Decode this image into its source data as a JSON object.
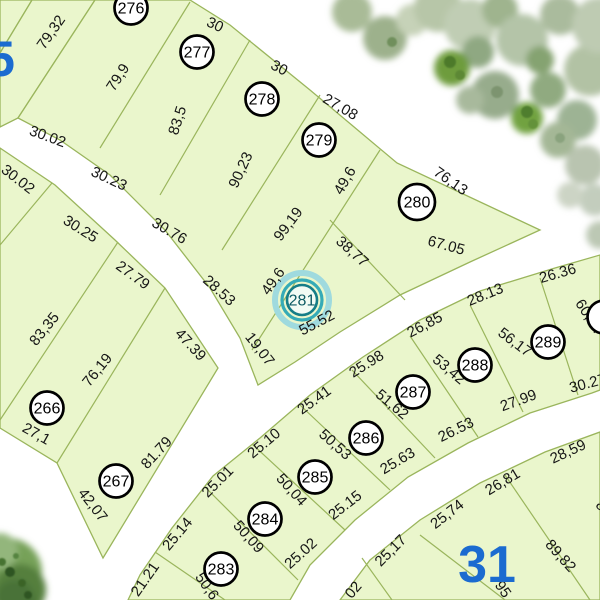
{
  "map": {
    "selected_parcel": "281",
    "colors": {
      "parcel_fill": "#eaf6cc",
      "parcel_stroke": "#9ab55c",
      "road": "#ffffff",
      "label_text": "#161616",
      "block_number_blue": "#1b6bd0",
      "highlight_teal_outer": "#9fdade",
      "highlight_teal_inner": "#35abb7"
    },
    "block_labels": [
      {
        "text": "5",
        "x": 1,
        "y": 76,
        "size": 50
      },
      {
        "text": "31",
        "x": 487,
        "y": 582,
        "size": 52
      }
    ],
    "parcel_badges": [
      {
        "num": "276",
        "x": 131,
        "y": 8,
        "r": 16.5,
        "selected": false
      },
      {
        "num": "277",
        "x": 197,
        "y": 52,
        "r": 16.5,
        "selected": false
      },
      {
        "num": "278",
        "x": 262,
        "y": 99,
        "r": 16.5,
        "selected": false
      },
      {
        "num": "279",
        "x": 319,
        "y": 140,
        "r": 16.5,
        "selected": false
      },
      {
        "num": "280",
        "x": 417,
        "y": 202,
        "r": 18,
        "selected": false
      },
      {
        "num": "281",
        "x": 302,
        "y": 300,
        "r": 15,
        "selected": true
      },
      {
        "num": "266",
        "x": 47,
        "y": 408,
        "r": 16.5,
        "selected": false
      },
      {
        "num": "267",
        "x": 116,
        "y": 481,
        "r": 16.5,
        "selected": false
      },
      {
        "num": "283",
        "x": 221,
        "y": 569,
        "r": 16.5,
        "selected": false
      },
      {
        "num": "284",
        "x": 265,
        "y": 519,
        "r": 16.5,
        "selected": false
      },
      {
        "num": "285",
        "x": 315,
        "y": 477,
        "r": 16.5,
        "selected": false
      },
      {
        "num": "286",
        "x": 366,
        "y": 438,
        "r": 16.5,
        "selected": false
      },
      {
        "num": "287",
        "x": 413,
        "y": 392,
        "r": 16.5,
        "selected": false
      },
      {
        "num": "288",
        "x": 475,
        "y": 365,
        "r": 16.5,
        "selected": false
      },
      {
        "num": "289",
        "x": 548,
        "y": 342,
        "r": 16.5,
        "selected": false
      },
      {
        "num": "",
        "x": 604,
        "y": 317,
        "r": 16.5,
        "selected": false
      }
    ],
    "dim_labels": [
      {
        "text": "79,32",
        "x": 55,
        "y": 35,
        "rot": -55
      },
      {
        "text": "79,9",
        "x": 122,
        "y": 80,
        "rot": -57
      },
      {
        "text": "30",
        "x": 213,
        "y": 29,
        "rot": 25
      },
      {
        "text": "30",
        "x": 277,
        "y": 72,
        "rot": 28
      },
      {
        "text": "27,08",
        "x": 338,
        "y": 111,
        "rot": 30
      },
      {
        "text": "76,13",
        "x": 448,
        "y": 185,
        "rot": 35
      },
      {
        "text": "30.02",
        "x": 46,
        "y": 141,
        "rot": 20
      },
      {
        "text": "30.23",
        "x": 107,
        "y": 183,
        "rot": 25
      },
      {
        "text": "30.76",
        "x": 167,
        "y": 235,
        "rot": 30
      },
      {
        "text": "28.53",
        "x": 216,
        "y": 294,
        "rot": 42
      },
      {
        "text": "19,07",
        "x": 256,
        "y": 352,
        "rot": 52
      },
      {
        "text": "83,5",
        "x": 182,
        "y": 122,
        "rot": -72
      },
      {
        "text": "90,23",
        "x": 245,
        "y": 172,
        "rot": -65
      },
      {
        "text": "49,6",
        "x": 349,
        "y": 183,
        "rot": -60
      },
      {
        "text": "99,19",
        "x": 292,
        "y": 227,
        "rot": -53
      },
      {
        "text": "49,6",
        "x": 277,
        "y": 284,
        "rot": -55
      },
      {
        "text": "38,77",
        "x": 349,
        "y": 255,
        "rot": 42
      },
      {
        "text": "67.05",
        "x": 445,
        "y": 250,
        "rot": 15
      },
      {
        "text": "55.52",
        "x": 319,
        "y": 327,
        "rot": -28
      },
      {
        "text": "30.02",
        "x": 15,
        "y": 183,
        "rot": 38
      },
      {
        "text": "30.25",
        "x": 78,
        "y": 233,
        "rot": 32
      },
      {
        "text": "27.79",
        "x": 130,
        "y": 279,
        "rot": 36
      },
      {
        "text": "47.39",
        "x": 187,
        "y": 348,
        "rot": 47
      },
      {
        "text": "83,35",
        "x": 48,
        "y": 332,
        "rot": -51
      },
      {
        "text": "76,19",
        "x": 101,
        "y": 373,
        "rot": -51
      },
      {
        "text": "27,1",
        "x": 34,
        "y": 438,
        "rot": 29
      },
      {
        "text": "42,07",
        "x": 89,
        "y": 508,
        "rot": 52
      },
      {
        "text": "81.79",
        "x": 160,
        "y": 456,
        "rot": -47
      },
      {
        "text": "21.21",
        "x": 149,
        "y": 582,
        "rot": -55
      },
      {
        "text": "25.14",
        "x": 181,
        "y": 537,
        "rot": -50
      },
      {
        "text": "25.01",
        "x": 221,
        "y": 485,
        "rot": -45
      },
      {
        "text": "25.10",
        "x": 267,
        "y": 447,
        "rot": -40
      },
      {
        "text": "25.41",
        "x": 317,
        "y": 404,
        "rot": -36
      },
      {
        "text": "25.98",
        "x": 369,
        "y": 368,
        "rot": -32
      },
      {
        "text": "26,85",
        "x": 427,
        "y": 329,
        "rot": -28
      },
      {
        "text": "28.13",
        "x": 487,
        "y": 299,
        "rot": -22
      },
      {
        "text": "26.36",
        "x": 559,
        "y": 278,
        "rot": -16
      },
      {
        "text": "50,6",
        "x": 203,
        "y": 589,
        "rot": 55
      },
      {
        "text": "50,09",
        "x": 245,
        "y": 540,
        "rot": 48
      },
      {
        "text": "50,04",
        "x": 288,
        "y": 493,
        "rot": 48
      },
      {
        "text": "50,53",
        "x": 332,
        "y": 448,
        "rot": 42
      },
      {
        "text": "51,62",
        "x": 389,
        "y": 408,
        "rot": 40
      },
      {
        "text": "53,42",
        "x": 446,
        "y": 373,
        "rot": 40
      },
      {
        "text": "56,17",
        "x": 512,
        "y": 346,
        "rot": 37
      },
      {
        "text": "60,34",
        "x": 585,
        "y": 319,
        "rot": 57
      },
      {
        "text": "25.02",
        "x": 304,
        "y": 557,
        "rot": -42
      },
      {
        "text": "25.15",
        "x": 348,
        "y": 509,
        "rot": -38
      },
      {
        "text": "25.63",
        "x": 400,
        "y": 465,
        "rot": -31
      },
      {
        "text": "26.53",
        "x": 458,
        "y": 434,
        "rot": -26
      },
      {
        "text": "27.99",
        "x": 520,
        "y": 405,
        "rot": -20
      },
      {
        "text": "30.27",
        "x": 589,
        "y": 388,
        "rot": -15
      },
      {
        "text": "25,17",
        "x": 394,
        "y": 554,
        "rot": -45
      },
      {
        "text": "25,74",
        "x": 450,
        "y": 518,
        "rot": -38
      },
      {
        "text": "26,81",
        "x": 505,
        "y": 486,
        "rot": -31
      },
      {
        "text": "28,59",
        "x": 570,
        "y": 456,
        "rot": -25
      },
      {
        "text": "89,82",
        "x": 557,
        "y": 559,
        "rot": 48
      },
      {
        "text": "95",
        "x": 499,
        "y": 592,
        "rot": 55
      },
      {
        "text": "02",
        "x": 357,
        "y": 593,
        "rot": -50
      },
      {
        "text": "8",
        "x": 598,
        "y": 509,
        "rot": 40
      }
    ]
  }
}
